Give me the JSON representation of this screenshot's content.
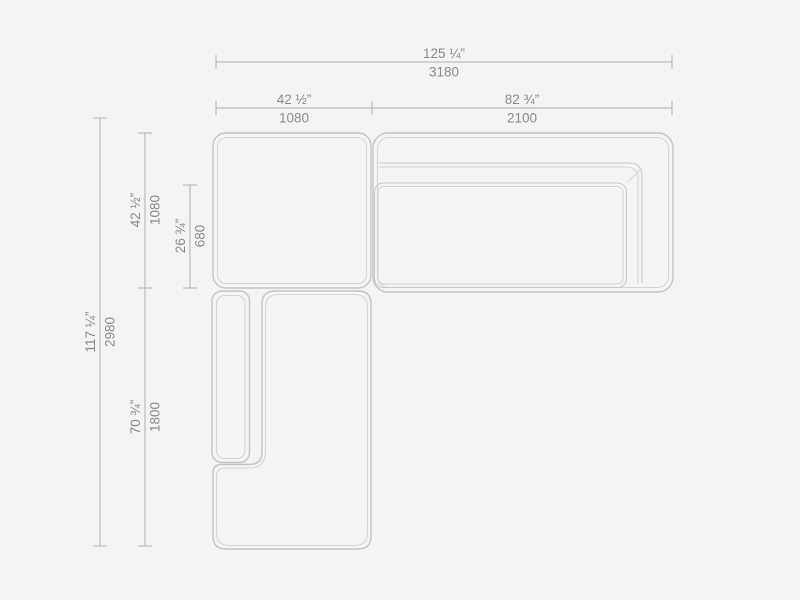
{
  "figure": {
    "background": "#f4f4f4",
    "outline_color": "#c4c4c4",
    "inner_line_color": "#d4d4d4",
    "dimension_line_color": "#b0b0b0",
    "text_color": "#8a8a8a"
  },
  "dims": {
    "top_total": {
      "in": "125 ¼”",
      "mm": "3180"
    },
    "top_left": {
      "in": "42 ½”",
      "mm": "1080"
    },
    "top_right": {
      "in": "82 ¾”",
      "mm": "2100"
    },
    "side_total": {
      "in": "117 ¼”",
      "mm": "2980"
    },
    "side_upper": {
      "in": "42 ½”",
      "mm": "1080"
    },
    "side_seat": {
      "in": "26 ¾”",
      "mm": "680"
    },
    "side_lower": {
      "in": "70 ¾”",
      "mm": "1800"
    }
  }
}
